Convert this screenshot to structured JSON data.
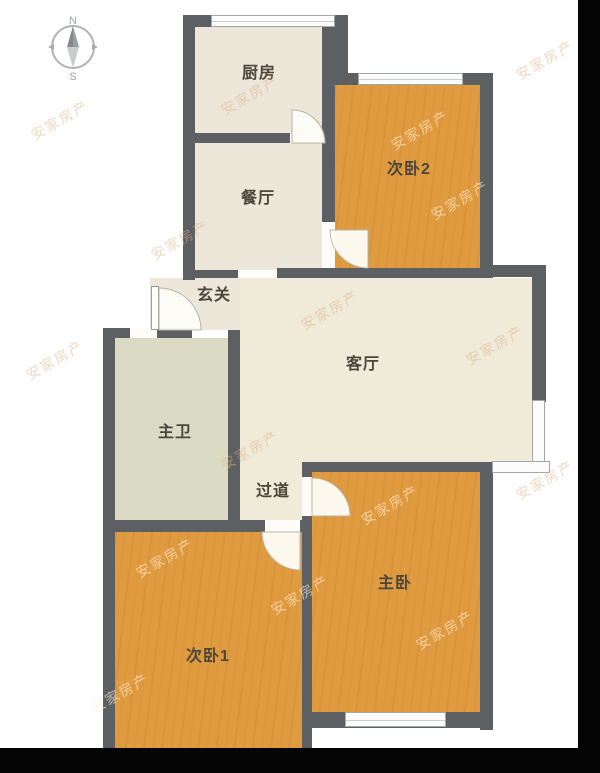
{
  "compass": {
    "north": "N",
    "south": "S"
  },
  "rooms": [
    {
      "name": "kitchen",
      "label": "厨房"
    },
    {
      "name": "dining",
      "label": "餐厅"
    },
    {
      "name": "entry",
      "label": "玄关"
    },
    {
      "name": "bedroom2",
      "label": "次卧2"
    },
    {
      "name": "living",
      "label": "客厅"
    },
    {
      "name": "bathroom",
      "label": "主卫"
    },
    {
      "name": "corridor",
      "label": "过道"
    },
    {
      "name": "master-bedroom",
      "label": "主卧"
    },
    {
      "name": "bedroom1",
      "label": "次卧1"
    }
  ],
  "watermark": {
    "text": "安家房产"
  },
  "colors": {
    "background": "#ffffff",
    "bar": "#050505",
    "wall": "#5c6063",
    "floor_beige": "#ece7d9",
    "floor_living": "#f0ead9",
    "floor_bath": "#dbdac4",
    "floor_wood": "#e09b40",
    "window_fill": "#fcfcfc",
    "window_frame": "#a3a7a7",
    "label": "#4b463c",
    "watermark_dark": "rgba(220,178,132,0.50)",
    "watermark_light": "rgba(255,241,220,0.60)",
    "compass": "#b0b2b3"
  }
}
